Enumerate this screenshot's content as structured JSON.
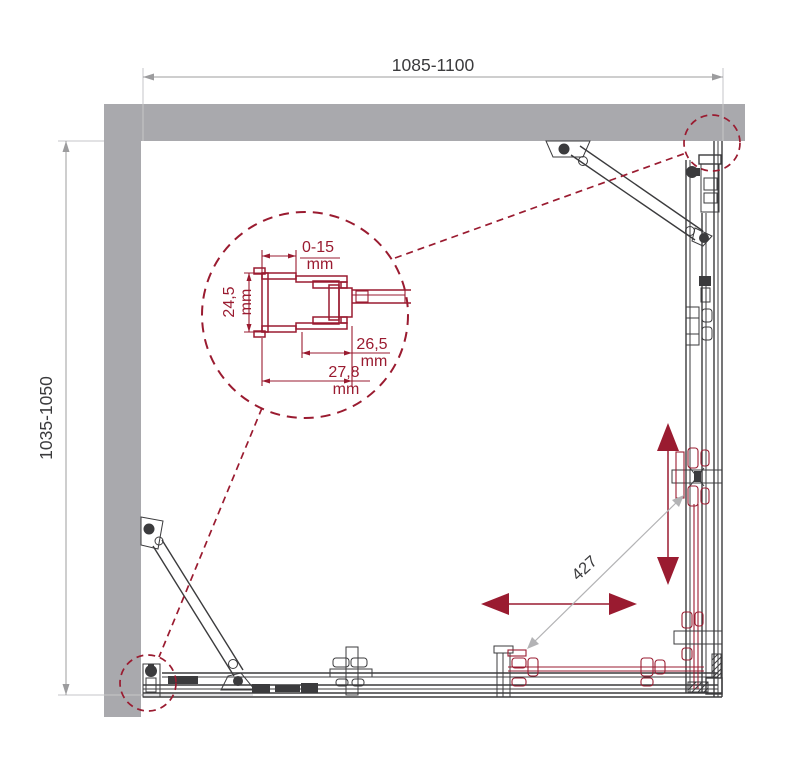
{
  "drawing": {
    "type": "technical-plan",
    "subject": "corner shower enclosure with sliding doors, top view",
    "dimensions": {
      "top_width": "1085-1100",
      "left_depth": "1035-1050",
      "entry_width": "427"
    },
    "detail": {
      "wall_adjustment": "0-15",
      "profile_depth": "24,5",
      "insert_width": "26,5",
      "profile_width": "27,8",
      "unit": "mm"
    },
    "colors": {
      "wall": "#a9a9ad",
      "line": "#3b3b3d",
      "dim": "#9c9c9e",
      "ext": "#c6c6c8",
      "leader": "#b3b3b5",
      "accent": "#9a1b30",
      "bg": "#ffffff"
    }
  }
}
